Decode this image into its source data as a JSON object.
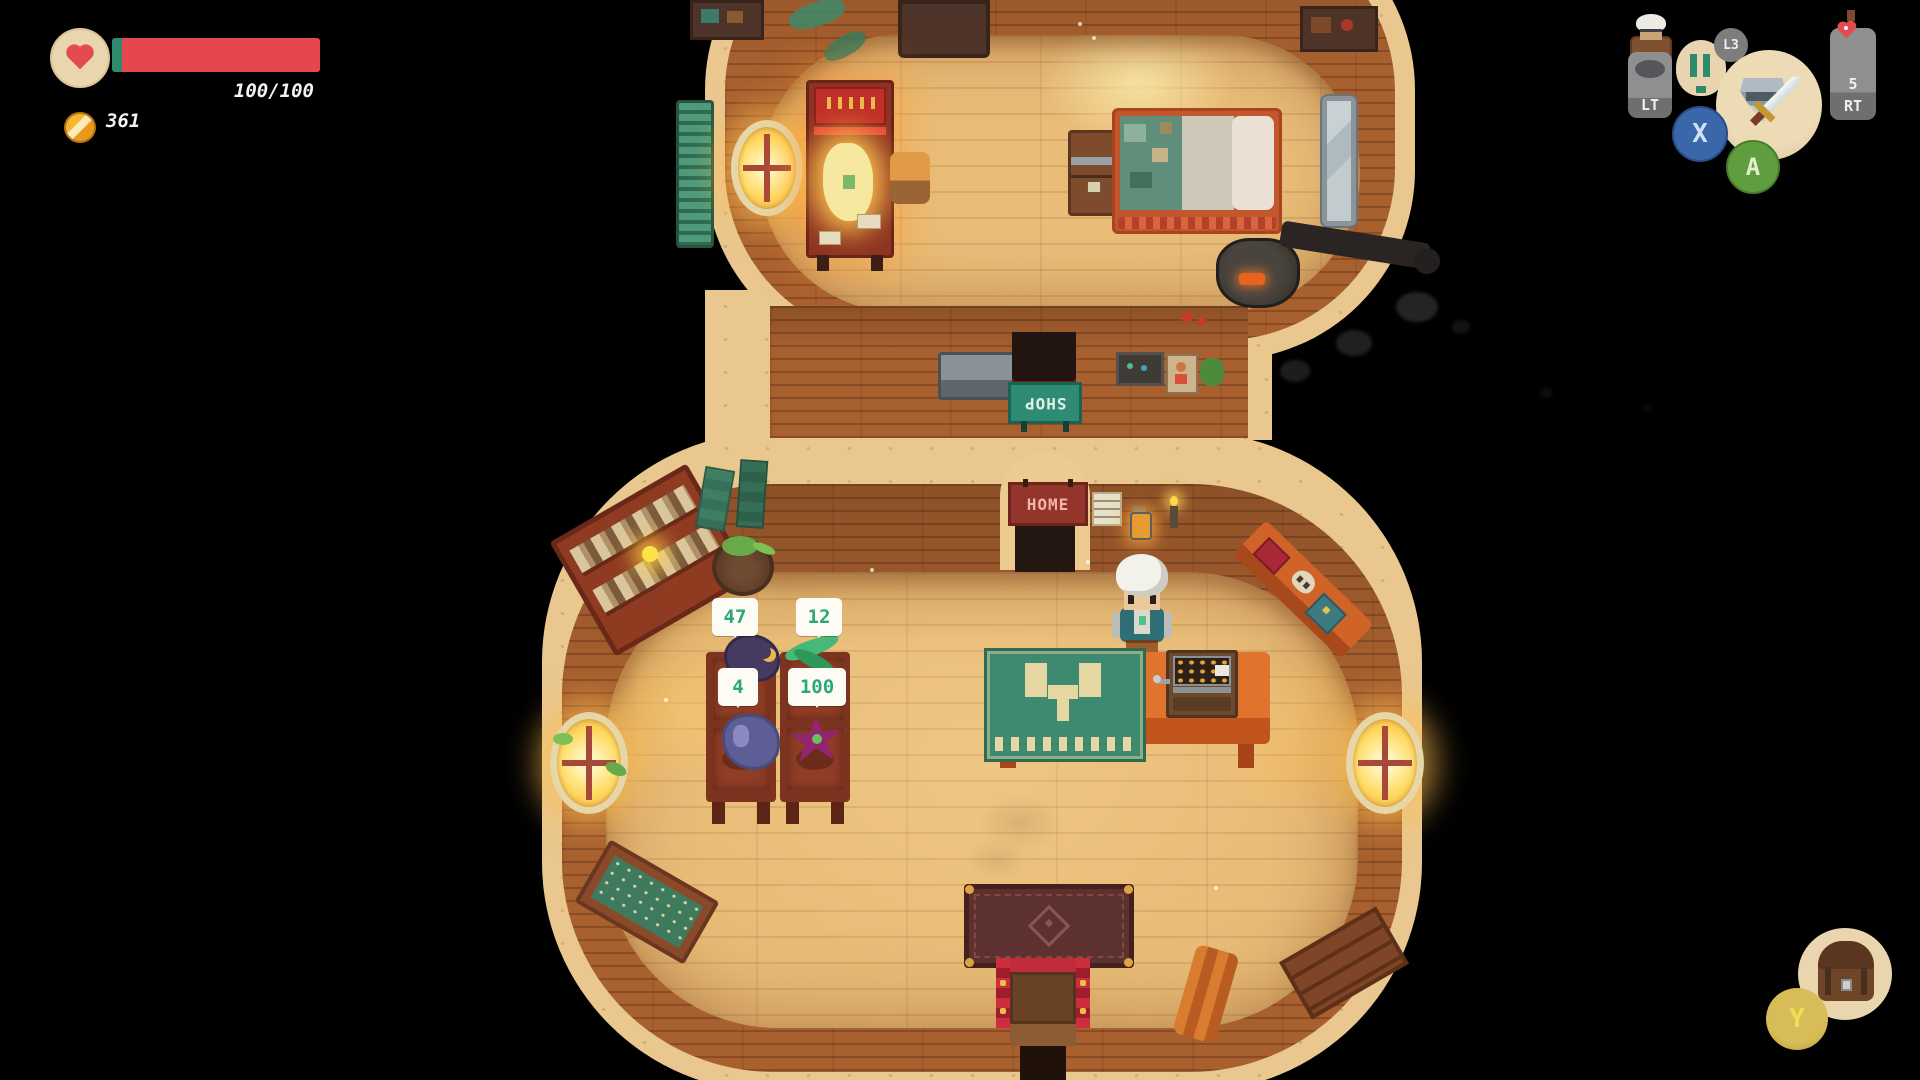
{
  "hud": {
    "health": {
      "value": "100/100"
    },
    "gold": {
      "value": "361"
    },
    "buttons": {
      "lt": "LT",
      "l3": "L3",
      "x": "X",
      "a": "A",
      "rt": "RT",
      "rt_count": "5",
      "y": "Y"
    }
  },
  "world": {
    "signs": {
      "shop": "SHOP",
      "home": "HOME"
    },
    "price_tags": {
      "slot1": "47",
      "slot2": "12",
      "slot3": "4",
      "slot4": "100"
    }
  },
  "colors": {
    "health_bar_red": "#e5474e",
    "hud_teal": "#2e8b6e",
    "price_green": "#2aa87c",
    "sand": "#e9c78e",
    "wall_brown": "#a8602f",
    "floor_tan": "#e9bd78",
    "sign_shop_teal": "#2e8b74",
    "sign_home_maroon": "#93352a",
    "button_x_blue": "#3a66aa",
    "button_a_green": "#5f9e3e",
    "button_y_yellow": "#d8bc58"
  }
}
